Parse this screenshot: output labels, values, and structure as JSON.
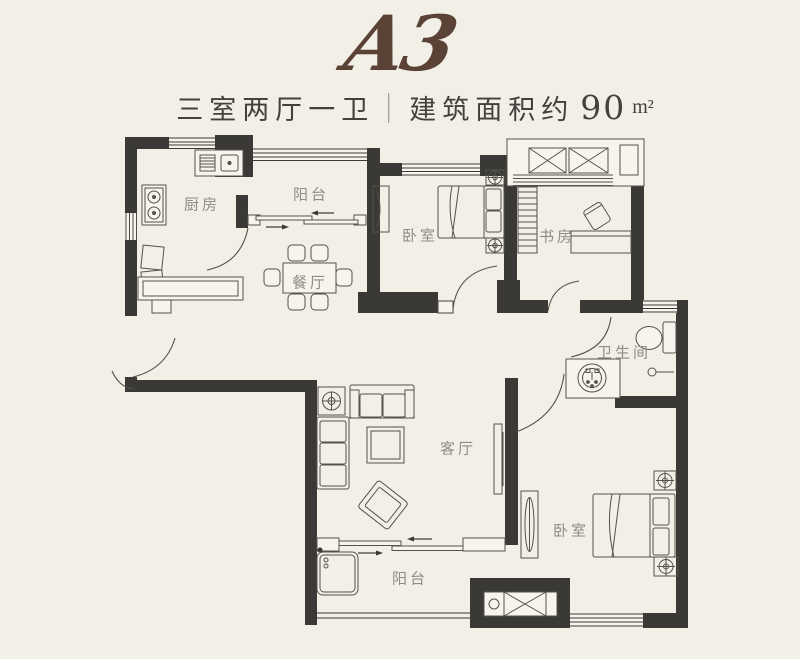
{
  "header": {
    "plan_code": "A3",
    "layout_type": "三室两厅一卫",
    "divider": "|",
    "area_text": "建筑面积约",
    "area_value": "90",
    "area_unit": "m²"
  },
  "rooms": {
    "kitchen": "厨房",
    "balcony_top": "阳台",
    "dining": "餐厅",
    "bedroom_top": "卧室",
    "study": "书房",
    "bathroom": "卫生间",
    "living": "客厅",
    "bedroom_right": "卧室",
    "balcony_bottom": "阳台"
  },
  "colors": {
    "background": "#f1efe6",
    "wall": "#3a3936",
    "furniture_line": "#54524c",
    "label": "#8f8d85",
    "logo_brown": "#5a4236",
    "title_text": "#42413d"
  }
}
